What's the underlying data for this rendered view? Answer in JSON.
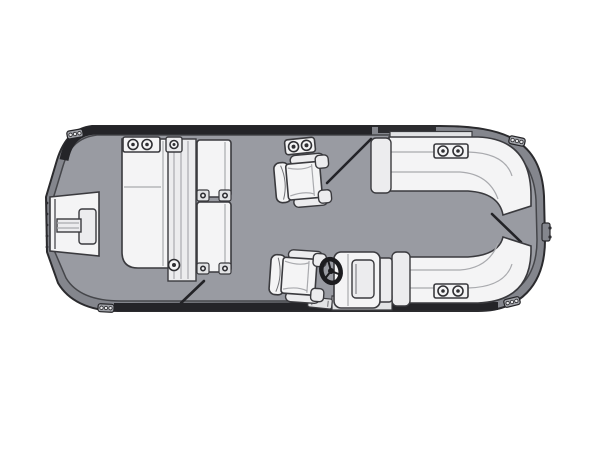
{
  "diagram": {
    "type": "floorplan",
    "subject": "pontoon-boat-top-view",
    "parts": [
      "bow boarding gate with step pad",
      "port lounge group with cup holders and hinged seat benches",
      "bow captain swivel chair",
      "gate hinge latch",
      "bow gate swing mark",
      "port side gate swing mark",
      "helm captain chair",
      "steering wheel",
      "helm console with base plate and step pad",
      "stern wraparound lounge top with cup holders",
      "stern wraparound lounge bottom with cup holders",
      "stern gate swing mark",
      "stern ladder tab",
      "four mooring cleats"
    ]
  },
  "colors": {
    "background": "#ffffff",
    "hull": "#84868d",
    "deck": "#999ba2",
    "band": "#242428",
    "band_light": "#2c2c30",
    "outline": "#2b2b2e",
    "upholstery": "#f4f4f5",
    "upholstery_shade": "#dcdde0",
    "hardware": "#1c1c1f"
  }
}
